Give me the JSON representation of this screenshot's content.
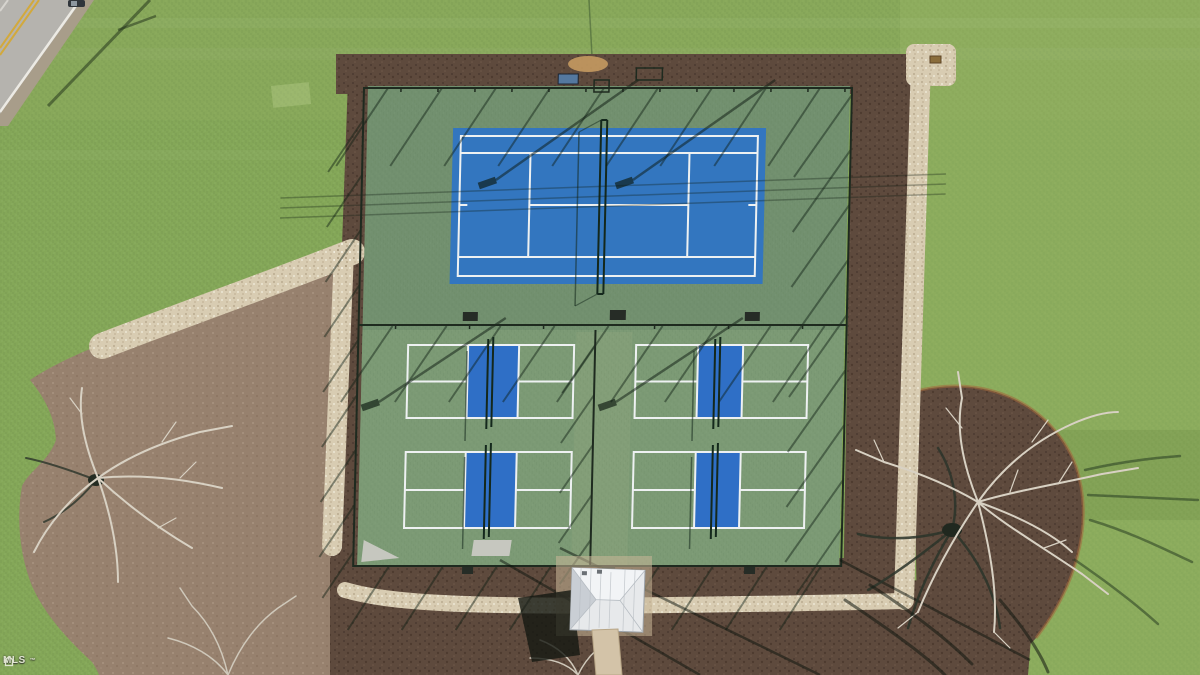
{
  "scene": {
    "type": "aerial-drone-photo",
    "description": "Overhead drone view of a fenced sports complex with one blue tennis court and four pickleball courts on green asphalt, surrounded by dark mulch beds, light gravel walking paths, a lawn, a road at top-left, bare winter trees, and a small white-roofed pavilion at the bottom.",
    "facility": {
      "tennis_courts": 1,
      "pickleball_courts": 4,
      "pavilions": 1
    },
    "watermark": {
      "label": "MLS",
      "suffix": "™"
    },
    "colors": {
      "grass": "#84a758",
      "grass_light": "#97b46a",
      "court_green": "#72906f",
      "pickleball_green": "#7e9c77",
      "tennis_blue": "#3376bf",
      "kitchen_blue": "#2f6fc6",
      "line_white": "#eef1f2",
      "mulch_dark": "#5e4a3d",
      "dirt_tan": "#97816e",
      "gravel": "#d8ccb2",
      "road_gray": "#b5b3ae",
      "road_yellow": "#d2a93c",
      "roof_white": "#e7e9eb",
      "shadow_dark": "#0e1c12",
      "branch_light": "#d8d1c3"
    }
  }
}
